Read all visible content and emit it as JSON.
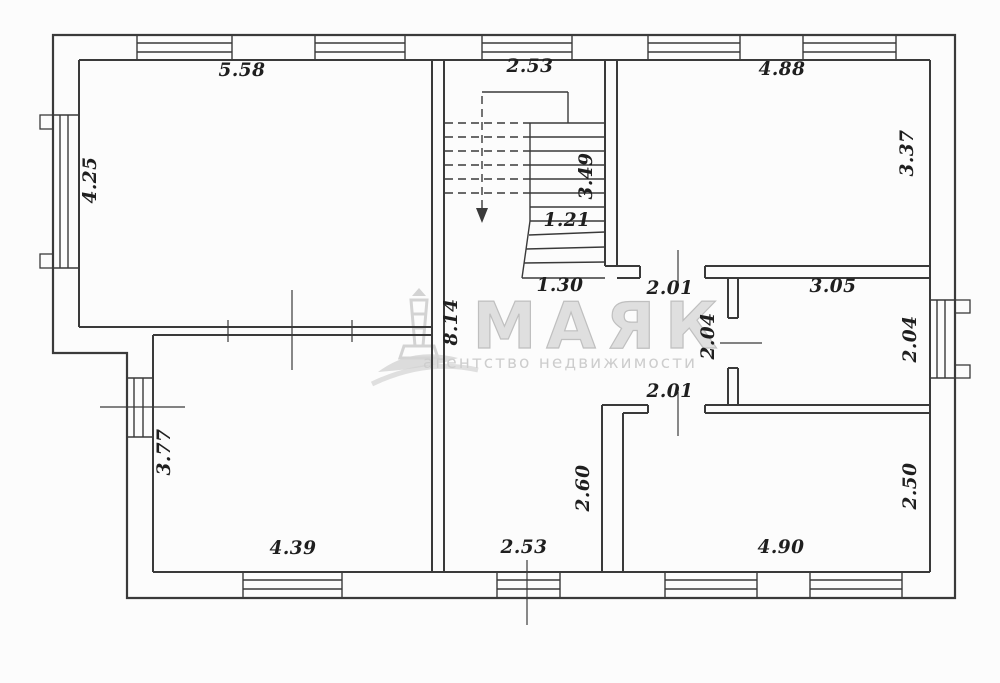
{
  "meta": {
    "width": 1000,
    "height": 683,
    "background": "#fcfcfc",
    "line_color": "#3a3a3a",
    "label_color": "#1f1f1f"
  },
  "watermark": {
    "title": "МАЯК",
    "subtitle": "агентство недвижимости",
    "title_color": "#dcdcdc",
    "title_stroke": "#b9b9b9",
    "subtitle_color": "#c9c9c9",
    "icon_color": "#cfcfcf",
    "title_x": 600,
    "title_y": 348,
    "subtitle_x": 560,
    "subtitle_y": 368
  },
  "plan": {
    "outer_path": "M53,35 H955 V598 H127 V353 H53 Z",
    "wall_lines": [
      [
        79,
        60,
        930,
        60
      ],
      [
        930,
        60,
        930,
        572
      ],
      [
        153,
        572,
        930,
        572
      ],
      [
        79,
        60,
        79,
        327
      ],
      [
        153,
        335,
        153,
        572
      ],
      [
        79,
        327,
        432,
        327
      ],
      [
        153,
        335,
        432,
        335
      ],
      [
        432,
        60,
        432,
        572
      ],
      [
        444,
        60,
        444,
        572
      ],
      [
        605,
        60,
        605,
        266
      ],
      [
        617,
        60,
        617,
        266
      ],
      [
        605,
        266,
        640,
        266
      ],
      [
        705,
        266,
        930,
        266
      ],
      [
        617,
        278,
        640,
        278
      ],
      [
        705,
        278,
        930,
        278
      ],
      [
        640,
        266,
        640,
        278
      ],
      [
        705,
        266,
        705,
        278
      ],
      [
        728,
        278,
        728,
        318
      ],
      [
        738,
        278,
        738,
        318
      ],
      [
        728,
        318,
        738,
        318
      ],
      [
        728,
        368,
        738,
        368
      ],
      [
        728,
        368,
        728,
        405
      ],
      [
        738,
        368,
        738,
        405
      ],
      [
        602,
        405,
        648,
        405
      ],
      [
        705,
        405,
        930,
        405
      ],
      [
        623,
        413,
        648,
        413
      ],
      [
        705,
        413,
        930,
        413
      ],
      [
        648,
        405,
        648,
        413
      ],
      [
        705,
        405,
        705,
        413
      ],
      [
        602,
        405,
        602,
        572
      ],
      [
        623,
        413,
        623,
        572
      ]
    ],
    "stair_lines": [
      [
        482,
        92,
        568,
        92
      ],
      [
        568,
        92,
        568,
        123
      ],
      [
        530,
        123,
        530,
        221
      ],
      [
        530,
        221,
        522,
        278
      ],
      [
        530,
        123,
        605,
        123
      ],
      [
        530,
        137,
        605,
        137
      ],
      [
        530,
        151,
        605,
        151
      ],
      [
        530,
        165,
        605,
        165
      ],
      [
        530,
        179,
        605,
        179
      ],
      [
        530,
        193,
        605,
        193
      ],
      [
        530,
        207,
        605,
        207
      ],
      [
        530,
        221,
        605,
        221
      ],
      [
        529,
        235,
        605,
        232
      ],
      [
        526,
        249,
        605,
        247
      ],
      [
        524,
        263,
        605,
        262
      ],
      [
        522,
        278,
        605,
        278
      ]
    ],
    "stair_dashed_lines": [
      [
        445,
        123,
        530,
        123
      ],
      [
        445,
        137,
        530,
        137
      ],
      [
        445,
        151,
        530,
        151
      ],
      [
        445,
        165,
        530,
        165
      ],
      [
        445,
        179,
        530,
        179
      ],
      [
        445,
        193,
        530,
        193
      ],
      [
        482,
        96,
        482,
        210
      ]
    ],
    "stair_arrow_points": "476,208 488,208 482,223",
    "window_lines": [
      [
        137,
        35,
        137,
        60
      ],
      [
        232,
        35,
        232,
        60
      ],
      [
        137,
        43,
        232,
        43
      ],
      [
        137,
        52,
        232,
        52
      ],
      [
        315,
        35,
        315,
        60
      ],
      [
        405,
        35,
        405,
        60
      ],
      [
        315,
        43,
        405,
        43
      ],
      [
        315,
        52,
        405,
        52
      ],
      [
        482,
        35,
        482,
        60
      ],
      [
        572,
        35,
        572,
        60
      ],
      [
        482,
        43,
        572,
        43
      ],
      [
        482,
        52,
        572,
        52
      ],
      [
        648,
        35,
        648,
        60
      ],
      [
        740,
        35,
        740,
        60
      ],
      [
        648,
        43,
        740,
        43
      ],
      [
        648,
        52,
        740,
        52
      ],
      [
        803,
        35,
        803,
        60
      ],
      [
        896,
        35,
        896,
        60
      ],
      [
        803,
        43,
        896,
        43
      ],
      [
        803,
        52,
        896,
        52
      ],
      [
        243,
        572,
        243,
        598
      ],
      [
        342,
        572,
        342,
        598
      ],
      [
        243,
        580,
        342,
        580
      ],
      [
        243,
        589,
        342,
        589
      ],
      [
        497,
        572,
        497,
        598
      ],
      [
        560,
        572,
        560,
        598
      ],
      [
        497,
        580,
        560,
        580
      ],
      [
        497,
        589,
        560,
        589
      ],
      [
        665,
        572,
        665,
        598
      ],
      [
        757,
        572,
        757,
        598
      ],
      [
        665,
        580,
        757,
        580
      ],
      [
        665,
        589,
        757,
        589
      ],
      [
        810,
        572,
        810,
        598
      ],
      [
        902,
        572,
        902,
        598
      ],
      [
        810,
        580,
        902,
        580
      ],
      [
        810,
        589,
        902,
        589
      ],
      [
        53,
        115,
        79,
        115
      ],
      [
        53,
        268,
        79,
        268
      ],
      [
        60,
        115,
        60,
        268
      ],
      [
        68,
        115,
        68,
        268
      ],
      [
        127,
        378,
        152,
        378
      ],
      [
        127,
        437,
        152,
        437
      ],
      [
        134,
        378,
        134,
        437
      ],
      [
        143,
        378,
        143,
        437
      ],
      [
        930,
        300,
        955,
        300
      ],
      [
        930,
        378,
        955,
        378
      ],
      [
        937,
        300,
        937,
        378
      ],
      [
        945,
        300,
        945,
        378
      ]
    ],
    "window_sill_rects": [
      [
        40,
        115,
        13,
        14
      ],
      [
        40,
        254,
        13,
        14
      ],
      [
        955,
        300,
        15,
        13
      ],
      [
        955,
        365,
        15,
        13
      ]
    ],
    "tick_lines": [
      [
        292,
        290,
        292,
        370
      ],
      [
        228,
        320,
        228,
        342
      ],
      [
        352,
        320,
        352,
        342
      ],
      [
        100,
        407,
        185,
        407
      ],
      [
        678,
        250,
        678,
        285
      ],
      [
        678,
        392,
        678,
        436
      ],
      [
        720,
        343,
        762,
        343
      ],
      [
        527,
        560,
        527,
        625
      ]
    ],
    "labels": [
      {
        "text": "5.58",
        "x": 242,
        "y": 76,
        "rot": 0
      },
      {
        "text": "2.53",
        "x": 530,
        "y": 72,
        "rot": 0
      },
      {
        "text": "4.88",
        "x": 782,
        "y": 75,
        "rot": 0
      },
      {
        "text": "4.25",
        "x": 96,
        "y": 180,
        "rot": -90
      },
      {
        "text": "3.37",
        "x": 913,
        "y": 153,
        "rot": -90
      },
      {
        "text": "3.49",
        "x": 592,
        "y": 176,
        "rot": -90
      },
      {
        "text": "1.21",
        "x": 567,
        "y": 226,
        "rot": 0
      },
      {
        "text": "1.30",
        "x": 560,
        "y": 291,
        "rot": 0
      },
      {
        "text": "2.01",
        "x": 670,
        "y": 294,
        "rot": 0
      },
      {
        "text": "3.05",
        "x": 833,
        "y": 292,
        "rot": 0
      },
      {
        "text": "2.04",
        "x": 714,
        "y": 336,
        "rot": -90
      },
      {
        "text": "2.04",
        "x": 916,
        "y": 339,
        "rot": -90
      },
      {
        "text": "8.14",
        "x": 457,
        "y": 322,
        "rot": -90
      },
      {
        "text": "2.01",
        "x": 670,
        "y": 397,
        "rot": 0
      },
      {
        "text": "2.60",
        "x": 589,
        "y": 488,
        "rot": -90
      },
      {
        "text": "2.50",
        "x": 916,
        "y": 486,
        "rot": -90
      },
      {
        "text": "3.77",
        "x": 170,
        "y": 452,
        "rot": -90
      },
      {
        "text": "4.39",
        "x": 293,
        "y": 554,
        "rot": 0
      },
      {
        "text": "2.53",
        "x": 524,
        "y": 553,
        "rot": 0
      },
      {
        "text": "4.90",
        "x": 781,
        "y": 553,
        "rot": 0
      }
    ]
  }
}
